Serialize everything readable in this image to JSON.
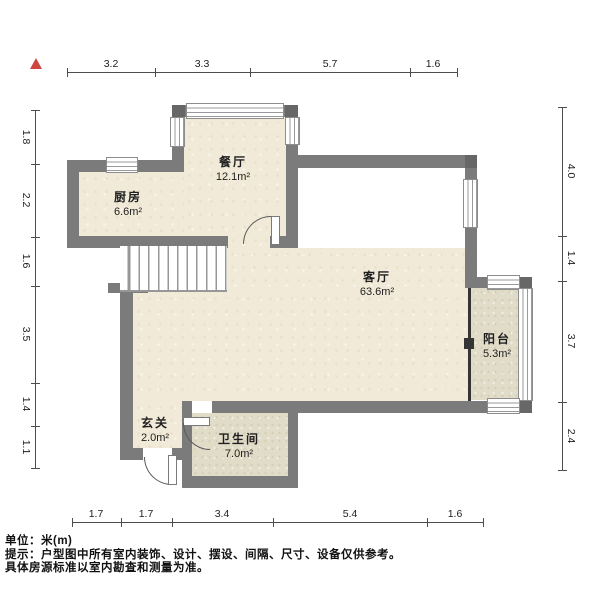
{
  "colors": {
    "wall": "#7b7b7b",
    "wall_corner_post": "#676767",
    "floor_main": "#f1ead8",
    "floor_wet": "#e0dcc8",
    "north_arrow": "#cd4640",
    "dimension_line": "#4d4d4d"
  },
  "north_arrow": {
    "icon": "north-arrow"
  },
  "rooms": [
    {
      "id": "dining",
      "name": "餐厅",
      "area": "12.1m²",
      "cx": 233,
      "cy": 168
    },
    {
      "id": "kitchen",
      "name": "厨房",
      "area": "6.6m²",
      "cx": 128,
      "cy": 203
    },
    {
      "id": "living",
      "name": "客厅",
      "area": "63.6m²",
      "cx": 377,
      "cy": 283
    },
    {
      "id": "balcony",
      "name": "阳台",
      "area": "5.3m²",
      "cx": 497,
      "cy": 345
    },
    {
      "id": "foyer",
      "name": "玄关",
      "area": "2.0m²",
      "cx": 155,
      "cy": 429
    },
    {
      "id": "bathroom",
      "name": "卫生间",
      "area": "7.0m²",
      "cx": 239,
      "cy": 445
    }
  ],
  "dimensions": {
    "top": {
      "side": "top",
      "orientation": "h",
      "line": 72,
      "start": 67,
      "end": 457,
      "ticks": [
        67,
        155,
        250,
        410,
        457
      ],
      "labels": [
        {
          "text": "3.2",
          "pos": 111
        },
        {
          "text": "3.3",
          "pos": 202
        },
        {
          "text": "5.7",
          "pos": 330
        },
        {
          "text": "1.6",
          "pos": 433
        }
      ]
    },
    "bottom": {
      "side": "bottom",
      "orientation": "h",
      "line": 522,
      "start": 72,
      "end": 483,
      "ticks": [
        72,
        121,
        172,
        273,
        427,
        483
      ],
      "labels": [
        {
          "text": "1.7",
          "pos": 96
        },
        {
          "text": "1.7",
          "pos": 146
        },
        {
          "text": "3.4",
          "pos": 222
        },
        {
          "text": "5.4",
          "pos": 350
        },
        {
          "text": "1.6",
          "pos": 455
        }
      ]
    },
    "left": {
      "side": "left",
      "orientation": "v",
      "line": 35,
      "start": 110,
      "end": 468,
      "ticks": [
        110,
        164,
        237,
        286,
        383,
        426,
        468
      ],
      "labels": [
        {
          "text": "1.8",
          "pos": 137
        },
        {
          "text": "2.2",
          "pos": 200
        },
        {
          "text": "1.6",
          "pos": 261
        },
        {
          "text": "3.5",
          "pos": 334
        },
        {
          "text": "1.4",
          "pos": 404
        },
        {
          "text": "1.1",
          "pos": 447
        }
      ]
    },
    "right": {
      "side": "right",
      "orientation": "v",
      "line": 562,
      "start": 107,
      "end": 470,
      "ticks": [
        107,
        236,
        281,
        402,
        470
      ],
      "labels": [
        {
          "text": "4.0",
          "pos": 171
        },
        {
          "text": "1.4",
          "pos": 258
        },
        {
          "text": "3.7",
          "pos": 341
        },
        {
          "text": "2.4",
          "pos": 436
        }
      ]
    }
  },
  "footer": {
    "unit": "单位：米(m)",
    "note1": "提示：户型图中所有室内装饰、设计、摆设、间隔、尺寸、设备仅供参考。",
    "note2": "具体房源标准以室内勘查和测量为准。"
  }
}
